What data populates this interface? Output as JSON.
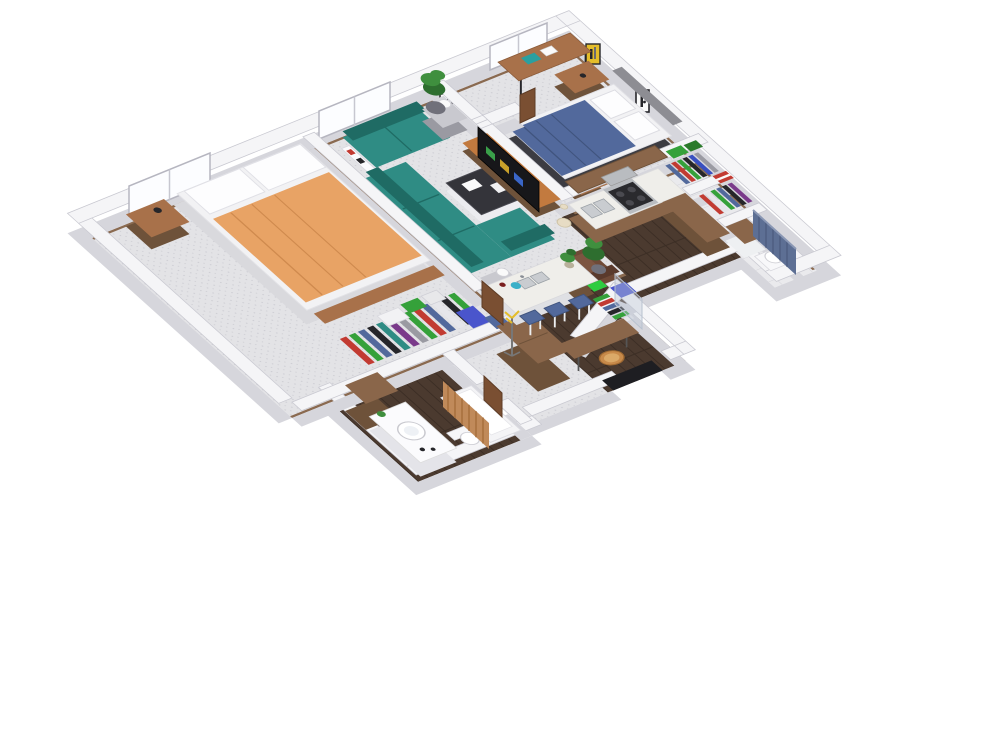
{
  "scene": {
    "type": "isometric-3d-floor-plan-render",
    "description": "3D isometric floor plan of a two-bedroom, two-bathroom apartment with open kitchen, living room, walk-in closets and entry hall"
  },
  "rooms": [
    {
      "name": "bedroom-1",
      "floor": "carpet",
      "furniture": [
        "orange-double-bed",
        "white-pillows",
        "nightstand-with-lamp",
        "foot-bench",
        "hanging-clothes-closet",
        "shelf-boxes",
        "storage-bags",
        "tall-dresser",
        "window"
      ]
    },
    {
      "name": "living-room",
      "floor": "carpet",
      "furniture": [
        "teal-loveseat",
        "teal-sectional-sofa",
        "coffee-table-with-papers",
        "media-console",
        "flat-tv",
        "side-table-lamp-right",
        "side-table-lamp-left",
        "tall-floor-plant",
        "armchair-with-plant",
        "wall-shelf",
        "floor-vase",
        "window",
        "framed-art"
      ]
    },
    {
      "name": "bedroom-2",
      "floor": "carpet",
      "furniture": [
        "navy-double-bed",
        "gray-headboard",
        "desk-with-laptop-and-book",
        "nightstand-a",
        "nightstand-b",
        "closet-nook-with-door",
        "window",
        "framed-art-yellow",
        "framed-art-bw"
      ]
    },
    {
      "name": "kitchen",
      "floor": "hardwood",
      "furniture": [
        "l-shaped-counter",
        "double-sink",
        "stove-four-burners",
        "microwave",
        "upper-cabinets",
        "white-island",
        "island-sink",
        "bar-stool-1",
        "bar-stool-2",
        "bar-stool-3",
        "kettle",
        "bottle",
        "potted-plant",
        "blue-tote-bag"
      ]
    },
    {
      "name": "walk-in-closet-1",
      "floor": "tile",
      "furniture": [
        "hanging-clothes",
        "green-towels-shelf"
      ]
    },
    {
      "name": "walk-in-closet-2",
      "floor": "tile",
      "furniture": [
        "hanging-clothes",
        "red-box-shelf"
      ]
    },
    {
      "name": "bathroom-2",
      "floor": "tile",
      "furniture": [
        "wood-top-vanity",
        "toilet",
        "shower-enclosure",
        "blue-shower-curtain"
      ]
    },
    {
      "name": "bathroom-1",
      "floor": "hardwood",
      "furniture": [
        "white-vanity-oval-sink",
        "linen-cabinet",
        "toilet",
        "bathtub",
        "tan-shower-curtain",
        "small-plant"
      ]
    },
    {
      "name": "entry-hall",
      "floor": "hardwood",
      "furniture": [
        "console-table",
        "wicker-basket",
        "coat-stand",
        "door-mat",
        "coat-closet-clothes",
        "glass-panel",
        "angled-wall"
      ]
    }
  ],
  "counts": {
    "bedrooms": 2,
    "bathrooms": 2,
    "bar_stools": 3,
    "walk_in_closets": 2,
    "windows": 3
  },
  "palette": {
    "wallTop": "#f5f5f7",
    "wallSide": "#d6d6dc",
    "wallEdge": "#c9c9d1",
    "carpet": "#e3e3e6",
    "carpetDot": "#cdcdd3",
    "wood": "#4b3a2f",
    "woodSeam": "#3b2d24",
    "tile": "#eaeaed",
    "tileLine": "#d4d4da",
    "baseboard": "#8a6a50",
    "teal": "#2f8c84",
    "tealDark": "#1f6b64",
    "orange": "#e8a365",
    "orangeDark": "#cf8a4e",
    "navy": "#52699c",
    "navyDark": "#40547e",
    "headboard": "#8d8d93",
    "woodFurn": "#a8714a",
    "woodMedia": "#c27a3f",
    "cab": "#8a664a",
    "cabDark": "#6e523a",
    "counter": "#efeeea",
    "steel": "#b9bcc0",
    "cooktop": "#2a2a2e",
    "black": "#26262a",
    "plant": "#3f8f3e",
    "plantDark": "#2e6e2f",
    "pot": "#70707a",
    "curtainBlue": "#5d6f94",
    "curtainTan": "#c08a5a",
    "red": "#c23b32",
    "green": "#35a13a",
    "blue": "#3950c0",
    "yellow": "#e4bd2a",
    "bagBlue": "#4a55cc",
    "cream": "#e7dcc4",
    "wicker": "#c88a4a",
    "door": "#7a4f32",
    "white": "#f6f6f8",
    "mattress": "#f2f2f4"
  }
}
